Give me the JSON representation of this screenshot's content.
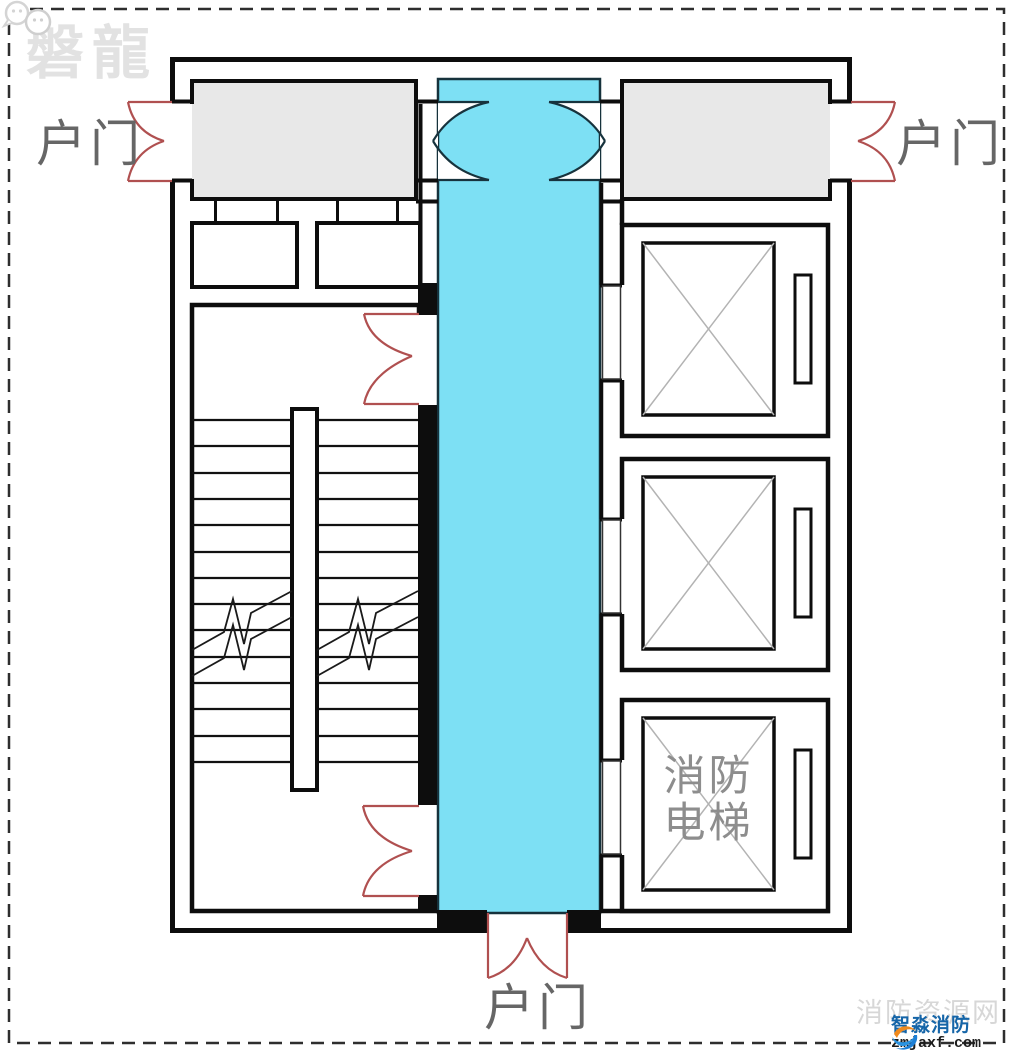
{
  "page": {
    "background": "#ffffff",
    "frame_color": "#2e2e2e"
  },
  "watermark": {
    "text": "磐龍"
  },
  "plan": {
    "door_labels": {
      "left": "户门",
      "right": "户门",
      "bottom": "户门"
    },
    "fire_elevator_label": {
      "line1": "消防",
      "line2": "电梯"
    },
    "colors": {
      "corridor_fill": "#7de0f4",
      "corridor_edge": "#16323c",
      "room_fill": "#e8e8e8",
      "wall": "#0d0d0d",
      "door_red": "#b05050",
      "elevator_x": "#b3b3b3",
      "label_gray": "#666666",
      "fire_label_gray": "#8d8d8d",
      "watermark_gray": "#e2e2e2"
    }
  },
  "footer": {
    "site_watermark": "消防资源网",
    "brand_name": "智淼消防",
    "brand_url": "zmjaxf.com"
  }
}
